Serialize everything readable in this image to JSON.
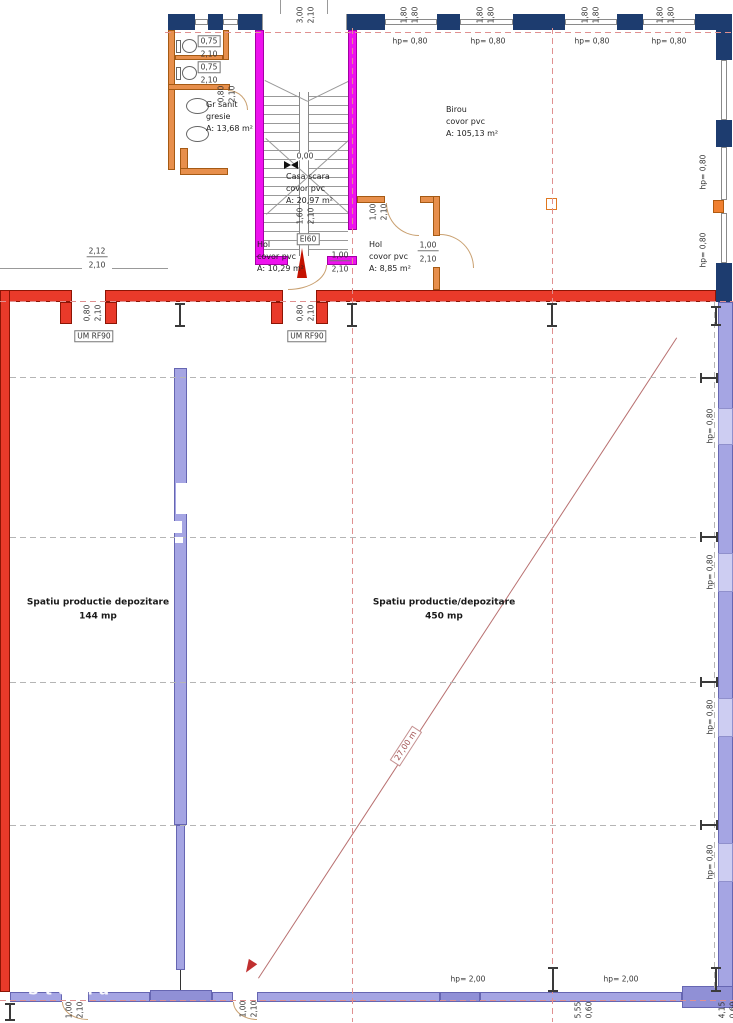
{
  "colors": {
    "navy": "#1d3c6f",
    "magenta": "#ee12ee",
    "magentaB": "#a300a3",
    "orange": "#e78f4c",
    "orangeB": "#a55a14",
    "red": "#e93a2a",
    "redB": "#8c1505",
    "purple": "#a5a5e3",
    "purpleD": "#9090d6",
    "purpleB": "#6666b2",
    "purpleWin": "#cdcdf2",
    "salmon": "#e09090",
    "grayDash": "#b5b5b5",
    "wallWin": "#ffffff"
  },
  "watermark": {
    "bottom_left": "Storia"
  },
  "rooms": [
    {
      "name": "Gr sanit",
      "finish": "gresie",
      "area": "A: 13,68 m²"
    },
    {
      "name": "Casa scara",
      "finish": "covor pvc",
      "area": "A: 20,97 m²"
    },
    {
      "name": "Birou",
      "finish": "covor pvc",
      "area": "A: 105,13 m²"
    },
    {
      "name": "Hol",
      "finish": "covor pvc",
      "area": "A: 10,29 m²"
    },
    {
      "name": "Hol",
      "finish": "covor pvc",
      "area": "A: 8,85 m²"
    },
    {
      "name": "Spatiu productie depozitare",
      "area": "144 mp"
    },
    {
      "name": "Spatiu productie/depozitare",
      "area": "450 mp"
    }
  ],
  "labels": [
    {
      "t": "3,00",
      "x": 300,
      "y": 15,
      "c": "rot"
    },
    {
      "t": "2,10",
      "x": 311,
      "y": 15,
      "c": "rot"
    },
    {
      "t": "1,80",
      "x": 404,
      "y": 15,
      "c": "rot"
    },
    {
      "t": "1,80",
      "x": 415,
      "y": 15,
      "c": "rot"
    },
    {
      "t": "1,80",
      "x": 480,
      "y": 15,
      "c": "rot"
    },
    {
      "t": "1,80",
      "x": 491,
      "y": 15,
      "c": "rot"
    },
    {
      "t": "1,80",
      "x": 585,
      "y": 15,
      "c": "rot"
    },
    {
      "t": "1,80",
      "x": 596,
      "y": 15,
      "c": "rot"
    },
    {
      "t": "1,80",
      "x": 660,
      "y": 15,
      "c": "rot"
    },
    {
      "t": "1,80",
      "x": 671,
      "y": 15,
      "c": "rot"
    },
    {
      "t": "hp= 0,80",
      "x": 410,
      "y": 41
    },
    {
      "t": "hp= 0,80",
      "x": 488,
      "y": 41
    },
    {
      "t": "hp= 0,80",
      "x": 592,
      "y": 41
    },
    {
      "t": "hp= 0,80",
      "x": 669,
      "y": 41
    },
    {
      "t": "hp= 0,80",
      "x": 703,
      "y": 172,
      "c": "rot"
    },
    {
      "t": "hp= 0,80",
      "x": 703,
      "y": 250,
      "c": "rot"
    },
    {
      "t": "hp= 0,80",
      "x": 710,
      "y": 426,
      "c": "rot"
    },
    {
      "t": "hp= 0,80",
      "x": 710,
      "y": 572,
      "c": "rot"
    },
    {
      "t": "hp= 0,80",
      "x": 710,
      "y": 717,
      "c": "rot"
    },
    {
      "t": "hp= 0,80",
      "x": 710,
      "y": 862,
      "c": "rot"
    },
    {
      "t": "0,75",
      "x": 209,
      "y": 41,
      "c": "box"
    },
    {
      "t": "2,10",
      "x": 209,
      "y": 54
    },
    {
      "t": "0,75",
      "x": 209,
      "y": 67,
      "c": "box"
    },
    {
      "t": "2,10",
      "x": 209,
      "y": 80
    },
    {
      "t": "0,80",
      "x": 221,
      "y": 94,
      "c": "rot"
    },
    {
      "t": "2,10",
      "x": 232,
      "y": 94,
      "c": "rot"
    },
    {
      "t": "Gr sanit",
      "x": 206,
      "y": 105,
      "c": "room",
      "n": "room-label-gr-sanit"
    },
    {
      "t": "gresie",
      "x": 206,
      "y": 117,
      "c": "room"
    },
    {
      "t": "A: 13,68 m²",
      "x": 206,
      "y": 129,
      "c": "room"
    },
    {
      "t": "0,00",
      "x": 305,
      "y": 156,
      "c": "bg",
      "n": "level-label"
    },
    {
      "t": "Casa scara",
      "x": 286,
      "y": 177,
      "c": "room",
      "n": "room-label-casa-scara"
    },
    {
      "t": "covor pvc",
      "x": 286,
      "y": 189,
      "c": "room"
    },
    {
      "t": "A: 20,97 m²",
      "x": 286,
      "y": 201,
      "c": "room"
    },
    {
      "t": "Birou",
      "x": 446,
      "y": 110,
      "c": "room",
      "n": "room-label-birou"
    },
    {
      "t": "covor pvc",
      "x": 446,
      "y": 122,
      "c": "room"
    },
    {
      "t": "A: 105,13 m²",
      "x": 446,
      "y": 134,
      "c": "room"
    },
    {
      "t": "1,60",
      "x": 300,
      "y": 216,
      "c": "rot"
    },
    {
      "t": "2,10",
      "x": 311,
      "y": 216,
      "c": "rot"
    },
    {
      "t": "EI60",
      "x": 308,
      "y": 239,
      "c": "box",
      "n": "fire-rating-label"
    },
    {
      "t": "Hol",
      "x": 257,
      "y": 245,
      "c": "room",
      "n": "room-label-hol-1"
    },
    {
      "t": "covor pvc",
      "x": 257,
      "y": 257,
      "c": "room"
    },
    {
      "t": "A: 10,29 m²",
      "x": 257,
      "y": 269,
      "c": "room"
    },
    {
      "t": "Hol",
      "x": 369,
      "y": 245,
      "c": "room",
      "n": "room-label-hol-2"
    },
    {
      "t": "covor pvc",
      "x": 369,
      "y": 257,
      "c": "room"
    },
    {
      "t": "A: 8,85 m²",
      "x": 369,
      "y": 269,
      "c": "room"
    },
    {
      "t": "1,00",
      "x": 373,
      "y": 212,
      "c": "rot"
    },
    {
      "t": "2,10",
      "x": 384,
      "y": 212,
      "c": "rot"
    },
    {
      "t": "1,00",
      "x": 428,
      "y": 246,
      "c": "ub"
    },
    {
      "t": "2,10",
      "x": 428,
      "y": 259
    },
    {
      "t": "1,00",
      "x": 340,
      "y": 256,
      "c": "ub"
    },
    {
      "t": "2,10",
      "x": 340,
      "y": 269
    },
    {
      "t": "2,12",
      "x": 97,
      "y": 252,
      "c": "ub"
    },
    {
      "t": "2,10",
      "x": 97,
      "y": 265
    },
    {
      "t": "0,80",
      "x": 87,
      "y": 313,
      "c": "rot"
    },
    {
      "t": "2,10",
      "x": 98,
      "y": 313,
      "c": "rot"
    },
    {
      "t": "UM RF90",
      "x": 94,
      "y": 336,
      "c": "box",
      "n": "fire-door-label"
    },
    {
      "t": "0,80",
      "x": 300,
      "y": 313,
      "c": "rot"
    },
    {
      "t": "2,10",
      "x": 311,
      "y": 313,
      "c": "rot"
    },
    {
      "t": "UM RF90",
      "x": 307,
      "y": 336,
      "c": "box",
      "n": "fire-door-label"
    },
    {
      "t": "Spatiu productie depozitare",
      "x": 98,
      "y": 603,
      "c": "lbl roomb",
      "n": "room-label-spatiu-144"
    },
    {
      "t": "144 mp",
      "x": 98,
      "y": 617,
      "c": "lbl roomb"
    },
    {
      "t": "Spatiu productie/depozitare",
      "x": 444,
      "y": 603,
      "c": "lbl roomb",
      "n": "room-label-spatiu-450"
    },
    {
      "t": "450 mp",
      "x": 444,
      "y": 617,
      "c": "lbl roomb"
    },
    {
      "t": "27,00 m",
      "x": 406,
      "y": 746,
      "c": "diag",
      "n": "measurement-label"
    },
    {
      "t": "hp= 2,00",
      "x": 468,
      "y": 979
    },
    {
      "t": "hp= 2,00",
      "x": 621,
      "y": 979
    },
    {
      "t": "1,00",
      "x": 69,
      "y": 1010,
      "c": "rot"
    },
    {
      "t": "2,10",
      "x": 80,
      "y": 1010,
      "c": "rot"
    },
    {
      "t": "1,00",
      "x": 243,
      "y": 1009,
      "c": "rot"
    },
    {
      "t": "2,10",
      "x": 254,
      "y": 1009,
      "c": "rot"
    },
    {
      "t": "5,55",
      "x": 578,
      "y": 1010,
      "c": "rot"
    },
    {
      "t": "0,60",
      "x": 589,
      "y": 1010,
      "c": "rot"
    },
    {
      "t": "4,15",
      "x": 722,
      "y": 1010,
      "c": "rot"
    },
    {
      "t": "0,60",
      "x": 733,
      "y": 1010,
      "c": "rot"
    },
    {
      "t": "Storia",
      "x": 28,
      "y": 990,
      "c": "wm",
      "n": "watermark"
    }
  ]
}
